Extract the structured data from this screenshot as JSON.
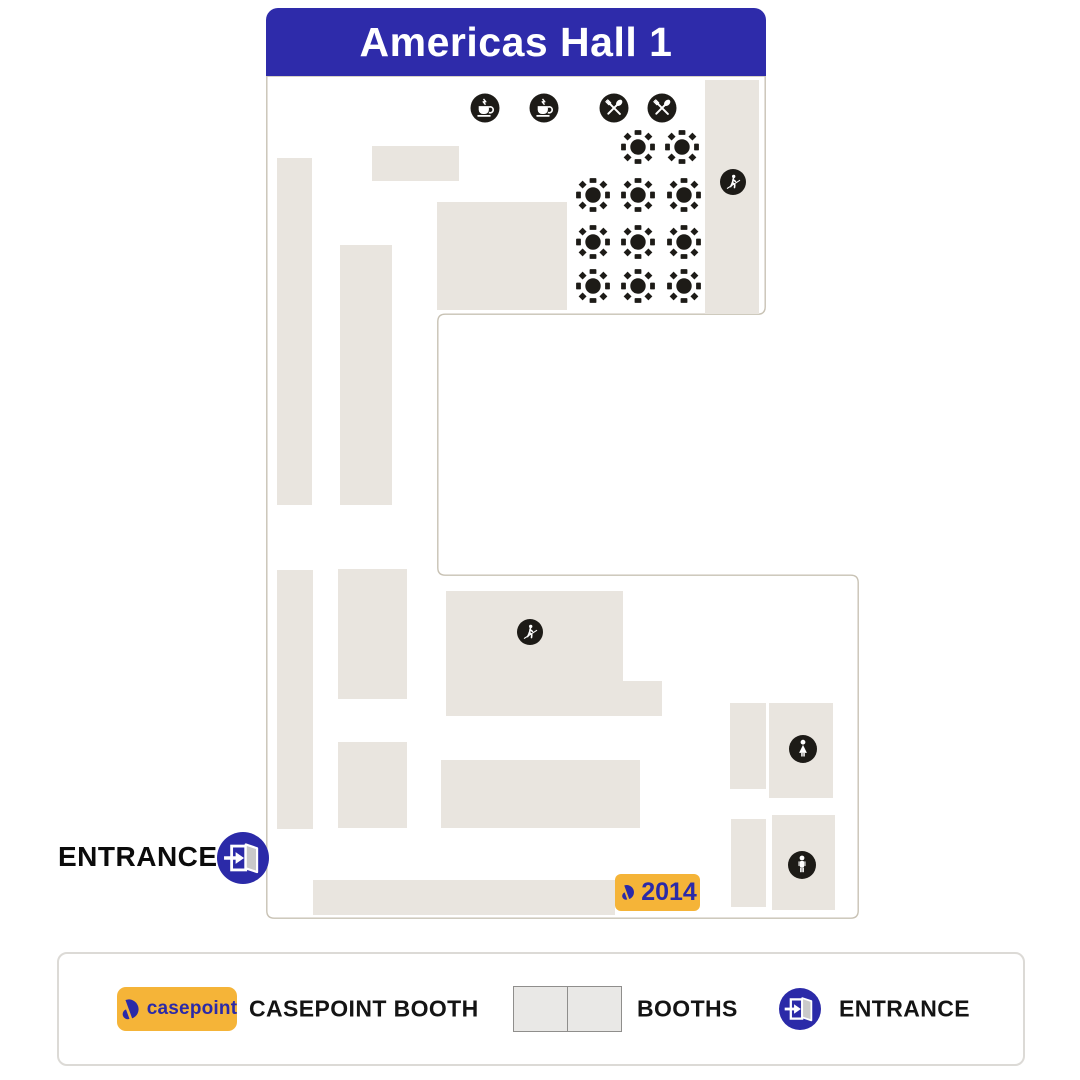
{
  "title": "Americas Hall 1",
  "entrance": {
    "label": "ENTRANCE"
  },
  "casepoint_booth_badge": {
    "number": "2014"
  },
  "legend": {
    "casepoint_logo_text": "casepoint",
    "casepoint_booth_label": "CASEPOINT BOOTH",
    "booths_label": "BOOTHS",
    "entrance_label": "ENTRANCE"
  },
  "colors": {
    "header_blue": "#2e2baa",
    "brand_blue": "#2b2aa8",
    "casepoint_yellow": "#f5b438",
    "booth_fill": "#e9e5df",
    "hall_outline": "#c8c2b4",
    "icon_black": "#1d1b17",
    "legend_border": "#dcdad6",
    "legend_booth_fill": "#e9e8e6",
    "legend_booth_border": "#8f8e8c"
  },
  "map": {
    "booths": [
      [
        277,
        158,
        35,
        347
      ],
      [
        372,
        146,
        87,
        35
      ],
      [
        340,
        245,
        52,
        260
      ],
      [
        437,
        202,
        130,
        108
      ],
      [
        705,
        80,
        54,
        234
      ],
      [
        277,
        570,
        36,
        259
      ],
      [
        338,
        569,
        69,
        130
      ],
      [
        338,
        742,
        69,
        86
      ],
      [
        446,
        591,
        177,
        90
      ],
      [
        446,
        681,
        86,
        35
      ],
      [
        532,
        681,
        130,
        35
      ],
      [
        441,
        760,
        199,
        68
      ],
      [
        730,
        703,
        36,
        86
      ],
      [
        769,
        703,
        64,
        95
      ],
      [
        731,
        819,
        35,
        88
      ],
      [
        772,
        815,
        63,
        95
      ],
      [
        313,
        880,
        302,
        35
      ]
    ],
    "tables": [
      [
        638,
        147
      ],
      [
        682,
        147
      ],
      [
        593,
        195
      ],
      [
        638,
        195
      ],
      [
        684,
        195
      ],
      [
        593,
        242
      ],
      [
        638,
        242
      ],
      [
        684,
        242
      ],
      [
        593,
        286
      ],
      [
        638,
        286
      ],
      [
        684,
        286
      ]
    ],
    "amenities": [
      {
        "type": "coffee",
        "x": 485,
        "y": 108
      },
      {
        "type": "coffee",
        "x": 544,
        "y": 108
      },
      {
        "type": "utensils",
        "x": 614,
        "y": 108
      },
      {
        "type": "utensils",
        "x": 662,
        "y": 108
      },
      {
        "type": "escalator",
        "x": 733,
        "y": 182
      },
      {
        "type": "escalator",
        "x": 530,
        "y": 632
      },
      {
        "type": "restroom-women",
        "x": 803,
        "y": 749
      },
      {
        "type": "restroom-men",
        "x": 802,
        "y": 865
      }
    ]
  }
}
